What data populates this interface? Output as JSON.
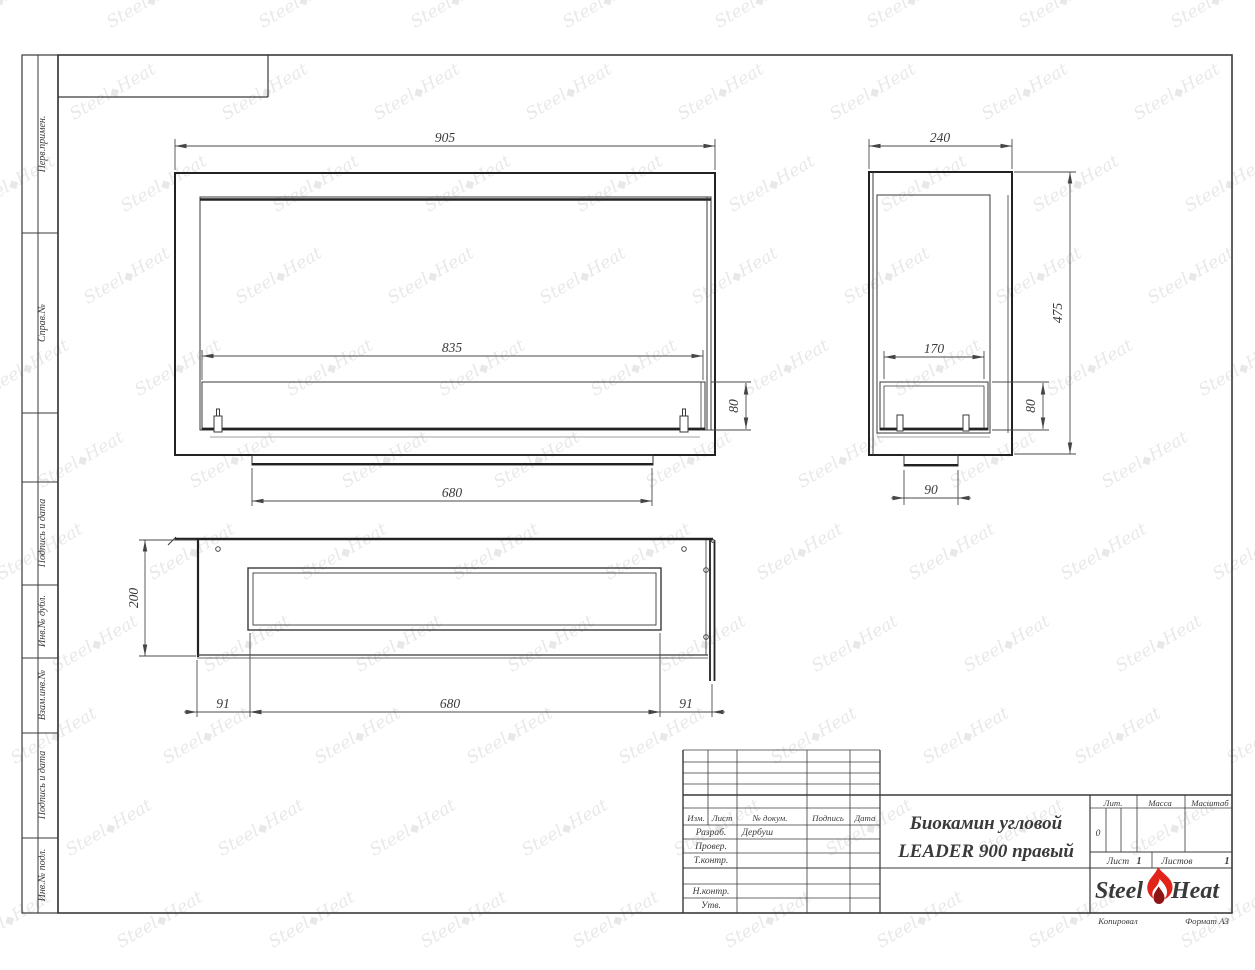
{
  "left_strip": {
    "labels": [
      "Перв.примен.",
      "Справ.№",
      "Подпись и дата",
      "Инв.№ дубл.",
      "Взам.инв.№",
      "Подпись и дата",
      "Инв.№ подл."
    ]
  },
  "views": {
    "front": {
      "dim_overall_width": "905",
      "dim_burner_width": "835",
      "dim_burner_height": "80",
      "dim_base_width": "680"
    },
    "side": {
      "dim_depth": "240",
      "dim_height": "475",
      "dim_burner_depth": "170",
      "dim_burner_height": "80",
      "dim_foot_width": "90"
    },
    "top": {
      "dim_depth": "200",
      "dim_offset_left": "91",
      "dim_slot_length": "680",
      "dim_offset_right": "91"
    }
  },
  "title_block": {
    "cols": [
      "Изм.",
      "Лист",
      "№ докум.",
      "Подпись",
      "Дата"
    ],
    "rows": [
      "Разраб.",
      "Провер.",
      "Т.контр.",
      "Н.контр.",
      "Утв."
    ],
    "developer": "Дербуш",
    "title_line1": "Биокамин угловой",
    "title_line2": "LEADER 900 правый",
    "lit_label": "Лит.",
    "lit_value": "0",
    "mass_label": "Масса",
    "scale_label": "Масштаб",
    "sheet_label": "Лист",
    "sheet_value": "1",
    "sheets_label": "Листов",
    "sheets_value": "1",
    "logo_steel": "Steel",
    "logo_heat": "Heat",
    "footer_copied": "Копировал",
    "footer_format": "Формат А3"
  },
  "watermark": {
    "steel": "Steel",
    "heat": "Heat"
  },
  "colors": {
    "line": "#3a3a3a",
    "thick_line": "#222222",
    "flame_red": "#e2231a",
    "flame_dark": "#8f1414"
  }
}
